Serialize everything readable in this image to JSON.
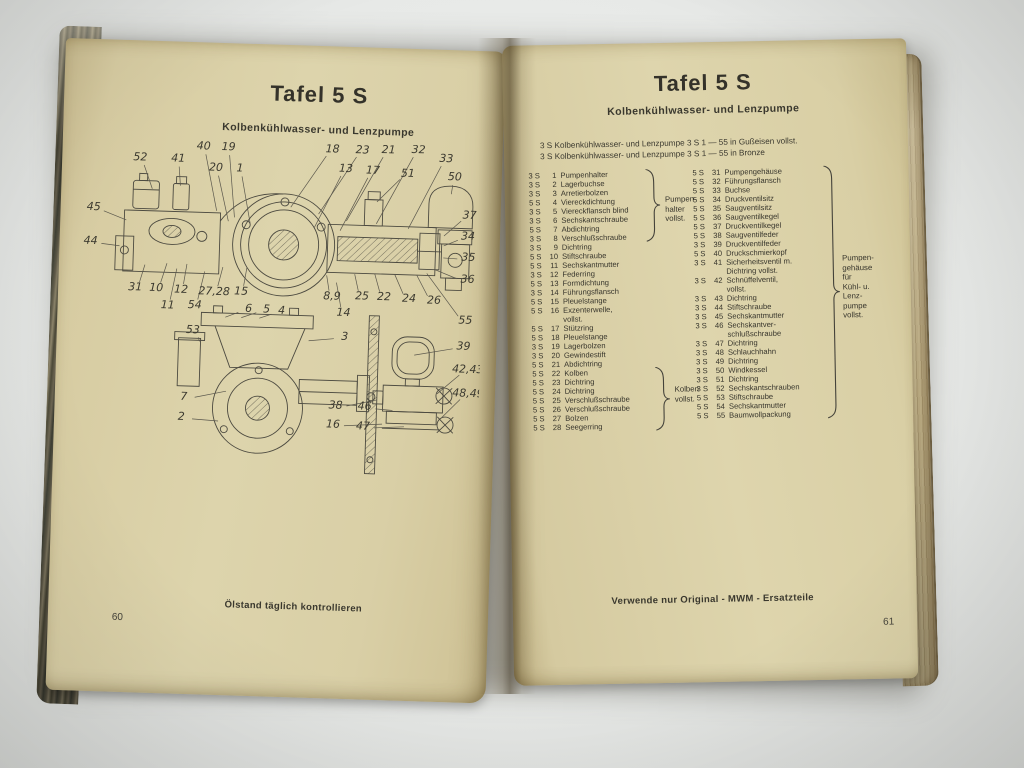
{
  "photo": {
    "surface_color": "#e8eae8",
    "paper_color": "#d9cfa6",
    "ink_color": "#3a382e"
  },
  "book": {
    "left_page": {
      "title": "Tafel 5 S",
      "subtitle": "Kolbenkühlwasser- und Lenzpumpe",
      "slogan": "Ölstand täglich kontrollieren",
      "page_number": "60",
      "diagram": {
        "type": "technical-sectional-drawing",
        "callouts": [
          {
            "label": "52",
            "x": 62,
            "y": 20,
            "tx": 75,
            "ty": 52
          },
          {
            "label": "41",
            "x": 100,
            "y": 20,
            "tx": 103,
            "ty": 48
          },
          {
            "label": "40",
            "x": 125,
            "y": 7,
            "tx": 140,
            "ty": 72
          },
          {
            "label": "19",
            "x": 150,
            "y": 7,
            "tx": 158,
            "ty": 78
          },
          {
            "label": "20",
            "x": 138,
            "y": 28,
            "tx": 152,
            "ty": 82
          },
          {
            "label": "1",
            "x": 162,
            "y": 28,
            "tx": 174,
            "ty": 84
          },
          {
            "label": "18",
            "x": 254,
            "y": 6,
            "tx": 214,
            "ty": 66
          },
          {
            "label": "23",
            "x": 284,
            "y": 6,
            "tx": 242,
            "ty": 72
          },
          {
            "label": "21",
            "x": 310,
            "y": 5,
            "tx": 270,
            "ty": 78
          },
          {
            "label": "32",
            "x": 340,
            "y": 4,
            "tx": 300,
            "ty": 80
          },
          {
            "label": "33",
            "x": 368,
            "y": 12,
            "tx": 332,
            "ty": 84
          },
          {
            "label": "13",
            "x": 268,
            "y": 25,
            "tx": 238,
            "ty": 86
          },
          {
            "label": "17",
            "x": 295,
            "y": 26,
            "tx": 264,
            "ty": 88
          },
          {
            "label": "51",
            "x": 330,
            "y": 28,
            "tx": 300,
            "ty": 58
          },
          {
            "label": "50",
            "x": 377,
            "y": 30,
            "tx": 374,
            "ty": 48
          },
          {
            "label": "45",
            "x": 17,
            "y": 71,
            "tx": 50,
            "ty": 84
          },
          {
            "label": "44",
            "x": 15,
            "y": 105,
            "tx": 44,
            "ty": 110
          },
          {
            "label": "37",
            "x": 393,
            "y": 68,
            "tx": 368,
            "ty": 90
          },
          {
            "label": "34",
            "x": 392,
            "y": 89,
            "tx": 368,
            "ty": 100
          },
          {
            "label": "35",
            "x": 393,
            "y": 110,
            "tx": 368,
            "ty": 112
          },
          {
            "label": "36",
            "x": 393,
            "y": 132,
            "tx": 360,
            "ty": 124
          },
          {
            "label": "31",
            "x": 61,
            "y": 150,
            "tx": 70,
            "ty": 128
          },
          {
            "label": "10",
            "x": 82,
            "y": 150,
            "tx": 92,
            "ty": 126
          },
          {
            "label": "12",
            "x": 107,
            "y": 151,
            "tx": 112,
            "ty": 126
          },
          {
            "label": "27,28",
            "x": 140,
            "y": 152,
            "tx": 148,
            "ty": 128
          },
          {
            "label": "15",
            "x": 167,
            "y": 151,
            "tx": 172,
            "ty": 128
          },
          {
            "label": "11",
            "x": 94,
            "y": 167,
            "tx": 102,
            "ty": 131
          },
          {
            "label": "54",
            "x": 121,
            "y": 166,
            "tx": 130,
            "ty": 133
          },
          {
            "label": "53",
            "x": 120,
            "y": 191,
            "tx": 127,
            "ty": 203
          },
          {
            "label": "6",
            "x": 175,
            "y": 168,
            "tx": 152,
            "ty": 178
          },
          {
            "label": "5",
            "x": 193,
            "y": 168,
            "tx": 168,
            "ty": 178
          },
          {
            "label": "4",
            "x": 208,
            "y": 169,
            "tx": 186,
            "ty": 178
          },
          {
            "label": "8,9",
            "x": 258,
            "y": 153,
            "tx": 252,
            "ty": 133
          },
          {
            "label": "25",
            "x": 288,
            "y": 152,
            "tx": 280,
            "ty": 131
          },
          {
            "label": "22",
            "x": 310,
            "y": 152,
            "tx": 300,
            "ty": 130
          },
          {
            "label": "24",
            "x": 335,
            "y": 153,
            "tx": 320,
            "ty": 130
          },
          {
            "label": "26",
            "x": 360,
            "y": 154,
            "tx": 342,
            "ty": 130
          },
          {
            "label": "14",
            "x": 270,
            "y": 169,
            "tx": 262,
            "ty": 140
          },
          {
            "label": "55",
            "x": 392,
            "y": 173,
            "tx": 352,
            "ty": 128
          },
          {
            "label": "3",
            "x": 272,
            "y": 193,
            "tx": 236,
            "ty": 199
          },
          {
            "label": "39",
            "x": 391,
            "y": 199,
            "tx": 342,
            "ty": 210
          },
          {
            "label": "42,43",
            "x": 396,
            "y": 222,
            "tx": 366,
            "ty": 248
          },
          {
            "label": "48,49",
            "x": 397,
            "y": 246,
            "tx": 371,
            "ty": 272
          },
          {
            "label": "38",
            "x": 265,
            "y": 262,
            "tx": 306,
            "ty": 256
          },
          {
            "label": "46",
            "x": 294,
            "y": 262,
            "tx": 322,
            "ty": 266
          },
          {
            "label": "16",
            "x": 263,
            "y": 281,
            "tx": 312,
            "ty": 280
          },
          {
            "label": "47",
            "x": 293,
            "y": 282,
            "tx": 334,
            "ty": 282
          },
          {
            "label": "7",
            "x": 113,
            "y": 258,
            "tx": 155,
            "ty": 252
          },
          {
            "label": "2",
            "x": 111,
            "y": 278,
            "tx": 148,
            "ty": 282
          }
        ]
      }
    },
    "right_page": {
      "title": "Tafel 5 S",
      "subtitle": "Kolbenkühlwasser- und Lenzpumpe",
      "intro_lines": [
        "3 S Kolbenkühlwasser- und Lenzpumpe 3 S 1 — 55 in Gußeisen vollst.",
        "3 S Kolbenkühlwasser- und Lenzpumpe 3 S 1 — 55 in Bronze"
      ],
      "parts_left": {
        "items": [
          {
            "prefix": "3 S",
            "num": "1",
            "name": "Pumpenhalter"
          },
          {
            "prefix": "3 S",
            "num": "2",
            "name": "Lagerbuchse"
          },
          {
            "prefix": "3 S",
            "num": "3",
            "name": "Arretierbolzen"
          },
          {
            "prefix": "5 S",
            "num": "4",
            "name": "Viereckdichtung"
          },
          {
            "prefix": "3 S",
            "num": "5",
            "name": "Viereckflansch blind"
          },
          {
            "prefix": "3 S",
            "num": "6",
            "name": "Sechskantschraube"
          },
          {
            "prefix": "5 S",
            "num": "7",
            "name": "Abdichtring"
          },
          {
            "prefix": "3 S",
            "num": "8",
            "name": "Verschlußschraube"
          },
          {
            "prefix": "3 S",
            "num": "9",
            "name": "Dichtring"
          },
          {
            "prefix": "5 S",
            "num": "10",
            "name": "Stiftschraube"
          },
          {
            "prefix": "5 S",
            "num": "11",
            "name": "Sechskantmutter"
          },
          {
            "prefix": "3 S",
            "num": "12",
            "name": "Federring"
          },
          {
            "prefix": "5 S",
            "num": "13",
            "name": "Formdichtung"
          },
          {
            "prefix": "3 S",
            "num": "14",
            "name": "Führungsflansch"
          },
          {
            "prefix": "5 S",
            "num": "15",
            "name": "Pleuelstange"
          },
          {
            "prefix": "5 S",
            "num": "16",
            "name": "Exzenterwelle,",
            "name2": "vollst."
          },
          {
            "prefix": "5 S",
            "num": "17",
            "name": "Stützring"
          },
          {
            "prefix": "5 S",
            "num": "18",
            "name": "Pleuelstange"
          },
          {
            "prefix": "3 S",
            "num": "19",
            "name": "Lagerbolzen"
          },
          {
            "prefix": "3 S",
            "num": "20",
            "name": "Gewindestift"
          },
          {
            "prefix": "5 S",
            "num": "21",
            "name": "Abdichtring"
          },
          {
            "prefix": "5 S",
            "num": "22",
            "name": "Kolben"
          },
          {
            "prefix": "5 S",
            "num": "23",
            "name": "Dichtring"
          },
          {
            "prefix": "5 S",
            "num": "24",
            "name": "Dichtring"
          },
          {
            "prefix": "5 S",
            "num": "25",
            "name": "Verschlußschraube"
          },
          {
            "prefix": "5 S",
            "num": "26",
            "name": "Verschlußschraube"
          },
          {
            "prefix": "5 S",
            "num": "27",
            "name": "Bolzen"
          },
          {
            "prefix": "5 S",
            "num": "28",
            "name": "Seegerring"
          }
        ],
        "bracket_label_lines": [
          "Pumpen-",
          "halter",
          "vollst."
        ],
        "bracket2_label_lines": [
          "Kolben",
          "vollst."
        ]
      },
      "parts_right": {
        "items": [
          {
            "prefix": "5 S",
            "num": "31",
            "name": "Pumpengehäuse"
          },
          {
            "prefix": "5 S",
            "num": "32",
            "name": "Führungsflansch"
          },
          {
            "prefix": "5 S",
            "num": "33",
            "name": "Buchse"
          },
          {
            "prefix": "5 S",
            "num": "34",
            "name": "Druckventilsitz"
          },
          {
            "prefix": "5 S",
            "num": "35",
            "name": "Saugventilsitz"
          },
          {
            "prefix": "5 S",
            "num": "36",
            "name": "Saugventilkegel"
          },
          {
            "prefix": "5 S",
            "num": "37",
            "name": "Druckventilkegel"
          },
          {
            "prefix": "5 S",
            "num": "38",
            "name": "Saugventilfeder"
          },
          {
            "prefix": "3 S",
            "num": "39",
            "name": "Druckventilfeder"
          },
          {
            "prefix": "5 S",
            "num": "40",
            "name": "Druckschmierkopf"
          },
          {
            "prefix": "3 S",
            "num": "41",
            "name": "Sicherheitsventil m.",
            "name2": "Dichtring vollst."
          },
          {
            "prefix": "3 S",
            "num": "42",
            "name": "Schnüffelventil,",
            "name2": "vollst."
          },
          {
            "prefix": "3 S",
            "num": "43",
            "name": "Dichtring"
          },
          {
            "prefix": "3 S",
            "num": "44",
            "name": "Stiftschraube"
          },
          {
            "prefix": "3 S",
            "num": "45",
            "name": "Sechskantmutter"
          },
          {
            "prefix": "3 S",
            "num": "46",
            "name": "Sechskantver-",
            "name2": "schlußschraube"
          },
          {
            "prefix": "3 S",
            "num": "47",
            "name": "Dichtring"
          },
          {
            "prefix": "3 S",
            "num": "48",
            "name": "Schlauchhahn"
          },
          {
            "prefix": "3 S",
            "num": "49",
            "name": "Dichtring"
          },
          {
            "prefix": "3 S",
            "num": "50",
            "name": "Windkessel"
          },
          {
            "prefix": "3 S",
            "num": "51",
            "name": "Dichtring"
          },
          {
            "prefix": "3 S",
            "num": "52",
            "name": "Sechskantschrauben"
          },
          {
            "prefix": "5 S",
            "num": "53",
            "name": "Stiftschraube"
          },
          {
            "prefix": "5 S",
            "num": "54",
            "name": "Sechskantmutter"
          },
          {
            "prefix": "5 S",
            "num": "55",
            "name": "Baumwollpackung"
          }
        ],
        "bracket_label_lines": [
          "Pumpen-",
          "gehäuse",
          "für",
          "Kühl- u.",
          "Lenz-",
          "pumpe",
          "vollst."
        ]
      },
      "slogan": "Verwende nur Original - MWM - Ersatzteile",
      "page_number": "61"
    }
  }
}
